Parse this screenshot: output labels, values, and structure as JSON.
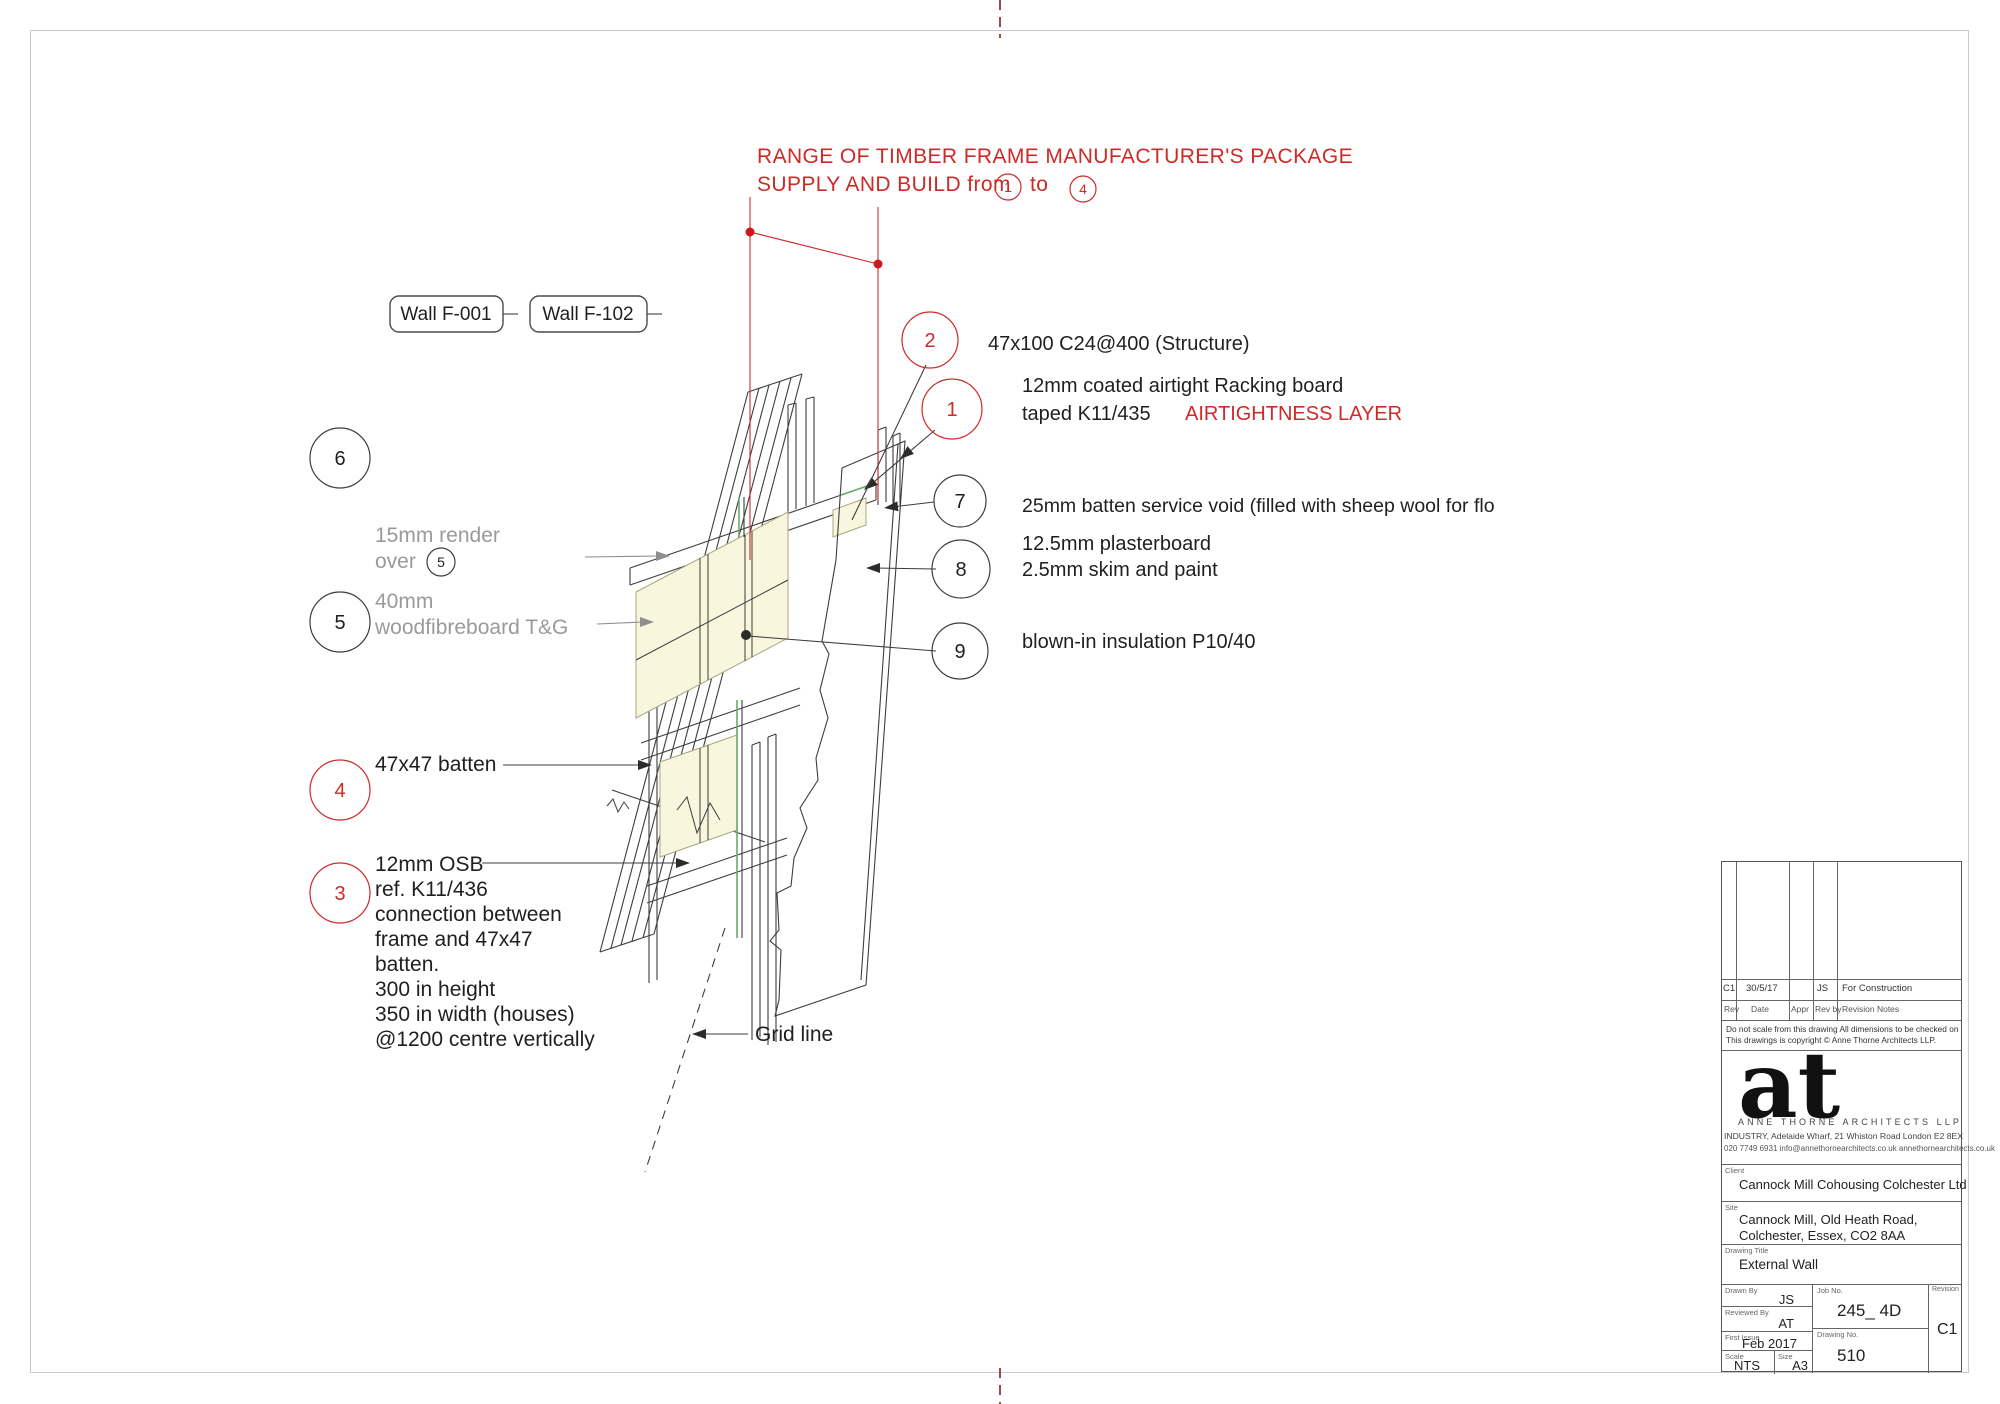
{
  "colors": {
    "red_accent": "#cd2a28",
    "gray_text": "#9a9a9a",
    "drawing_line": "#3d3d3d",
    "insulation_fill": "#f8f6dd",
    "racking_green": "#69aa69",
    "center_mark": "#9b4a4a"
  },
  "header": {
    "line1": "RANGE OF TIMBER FRAME MANUFACTURER'S PACKAGE",
    "line2_prefix": "SUPPLY AND BUILD from",
    "range_start": "1",
    "range_connector": "to",
    "range_end": "4"
  },
  "wall_tags": {
    "tag1": "Wall F-001",
    "tag2": "Wall F-102"
  },
  "callouts": {
    "c1": {
      "num": "1",
      "line1": "12mm coated airtight Racking board",
      "line2": "taped  K11/435",
      "line2_red": "AIRTIGHTNESS LAYER"
    },
    "c2": {
      "num": "2",
      "text": "47x100 C24@400 (Structure)"
    },
    "c3": {
      "num": "3",
      "lines": [
        "12mm OSB",
        "ref. K11/436",
        "connection between",
        "frame and 47x47",
        "batten.",
        "300 in height",
        "350 in width (houses)",
        "@1200 centre vertically"
      ]
    },
    "c4": {
      "num": "4",
      "text": "47x47 batten"
    },
    "c5": {
      "num": "5",
      "line1": "40mm",
      "line2": "woodfibreboard T&G"
    },
    "c5_inline": {
      "line1": "15mm render",
      "line2": "over",
      "num": "5"
    },
    "c6": {
      "num": "6"
    },
    "c7": {
      "num": "7",
      "text": "25mm batten service void (filled with sheep wool for flo"
    },
    "c8": {
      "num": "8",
      "line1": "12.5mm plasterboard",
      "line2": "2.5mm skim and paint"
    },
    "c9": {
      "num": "9",
      "text": "blown-in insulation P10/40"
    }
  },
  "drawing": {
    "grid_line_label": "Grid line"
  },
  "title_block": {
    "revision_row": {
      "rev": "C1",
      "date": "30/5/17",
      "appr": "",
      "rev_by": "JS",
      "notes": "For Construction"
    },
    "table_header": {
      "rev": "Rev",
      "date": "Date",
      "appr": "Appr",
      "rev_by": "Rev by",
      "notes": "Revision Notes"
    },
    "disclaimer1": "Do not scale from this drawing  All dimensions to be checked on site",
    "disclaimer2": "This  drawings  is  copyright  ©  Anne Thorne Architects LLP.",
    "logo": "at",
    "firm_name": "ANNE THORNE ARCHITECTS LLP",
    "address_line1": "INDUSTRY, Adelaide Wharf, 21 Whiston Road  London  E2 8EX",
    "address_line2": "020 7749 6931   info@annethornearchitects.co.uk   annethornearchitects.co.uk",
    "client_label": "Client",
    "client": "Cannock Mill Cohousing Colchester Ltd",
    "site_label": "Site",
    "site_line1": "Cannock Mill, Old Heath Road,",
    "site_line2": "Colchester, Essex, CO2 8AA",
    "drawing_title_label": "Drawing Title",
    "drawing_title": "External Wall",
    "drawn_by_label": "Drawn By",
    "drawn_by": "JS",
    "reviewed_by_label": "Reviewed By",
    "reviewed_by": "AT",
    "first_issue_label": "First Issue",
    "first_issue": "Feb 2017",
    "scale_label": "Scale",
    "scale": "NTS",
    "size_label": "Size",
    "size": "A3",
    "job_no_label": "Job No.",
    "job_no": "245_ 4D",
    "drawing_no_label": "Drawing No.",
    "drawing_no": "510",
    "revision_label": "Revision",
    "revision": "C1"
  }
}
